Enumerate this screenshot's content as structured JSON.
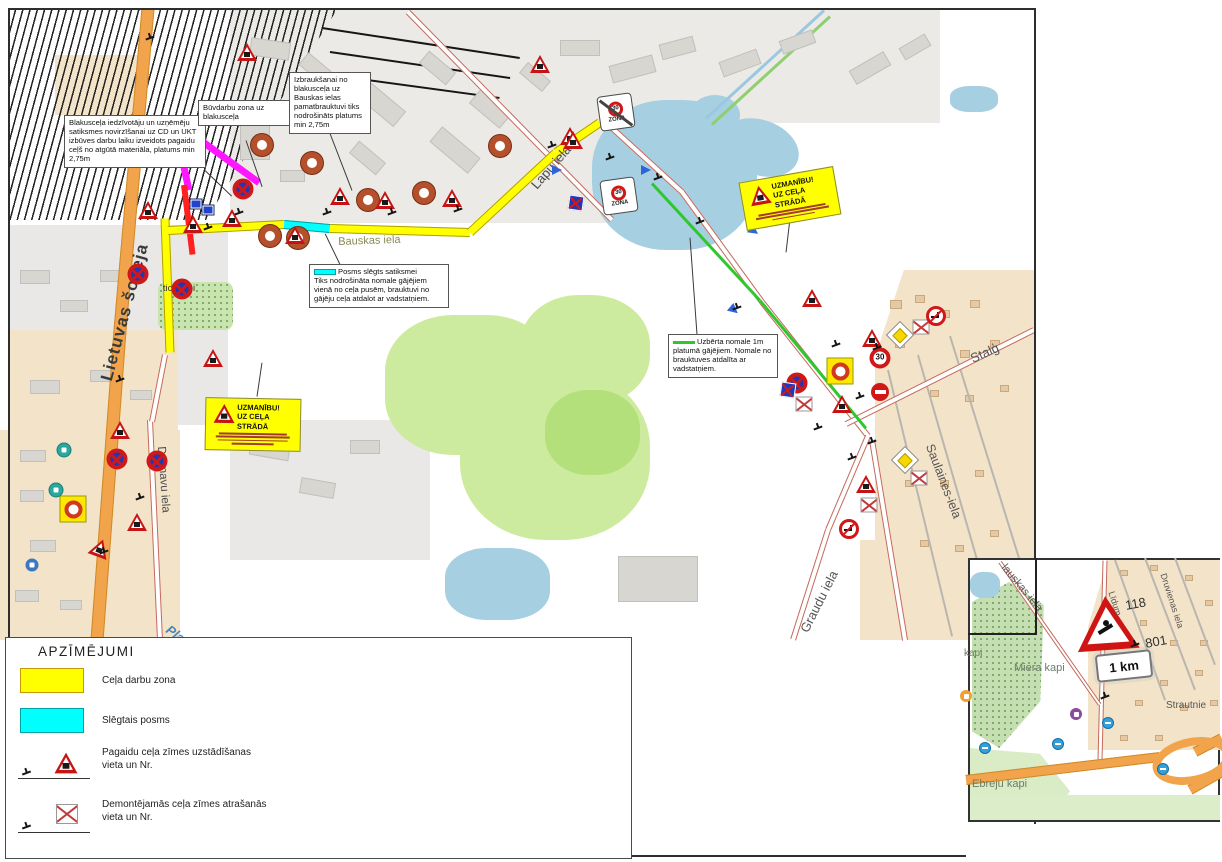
{
  "legend": {
    "title": "APZĪMĒJUMI",
    "items": [
      {
        "label": "Ceļa darbu zona",
        "swatch": "yellow"
      },
      {
        "label": "Slēgtais posms",
        "swatch": "cyan"
      },
      {
        "label": "Pagaidu ceļa zīmes uzstādīšanas vieta un Nr.",
        "swatch": "temporary-sign"
      },
      {
        "label": "Demontējamās ceļa zīmes atrašanās vieta un Nr.",
        "swatch": "removed-sign"
      }
    ]
  },
  "annotations": {
    "blakuscela": "Blakusceļa iedzīvotāju un uzņēmēju satiksmes novirzīšanai uz CD un UKT izbūves darbu laiku izveidots pagaidu ceļš no atgūtā materiāla, platums min 2,75m",
    "buvdarbu": "Būvdarbu zona uz blakusceļa",
    "izbrauksanai": "Izbraukšanai no blakusceļa uz Bauskas ielas pamatbrauktuvi tiks nodrošināts platums min 2,75m",
    "posms_title": "Posms slēgts  satiksmei",
    "posms_body": "Tiks nodrošināta nomale gājējiem vienā no ceļa pusēm, brauktuvi no gājēju ceļa atdalot ar vadstatņiem.",
    "uzberta": "Uzbērta nomale 1m platumā gājējiem. Nomale no brauktuves atdalīta ar vadstatņiem.",
    "warning_title": "UZMANĪBU!",
    "warning_subtitle": "UZ CEĻA STRĀDĀ"
  },
  "signs_text": {
    "thirty": "30",
    "zona": "ZONA"
  },
  "map_labels": [
    {
      "text": "Lietuvas šoseja",
      "x": 97,
      "y": 378,
      "rot": -75,
      "size": 17,
      "color": "#3a3a3a",
      "bold": true,
      "spacing": 1
    },
    {
      "text": "Bauskas iela",
      "x": 338,
      "y": 236,
      "rot": -2,
      "size": 11,
      "color": "#8a8a58",
      "bold": false
    },
    {
      "text": "Lapu iela",
      "x": 528,
      "y": 182,
      "rot": -49,
      "size": 13,
      "color": "#4a4a4a",
      "bold": false
    },
    {
      "text": "Dzirnavu iela",
      "x": 167,
      "y": 446,
      "rot": 86,
      "size": 11.5,
      "color": "#4a4a4a",
      "bold": false
    },
    {
      "text": "tic. kapi",
      "x": 160,
      "y": 283,
      "rot": 0,
      "size": 9.5,
      "color": "#333333",
      "bold": false,
      "w": 38
    },
    {
      "text": "Stalģ",
      "x": 968,
      "y": 352,
      "rot": -24,
      "size": 13,
      "color": "#555555",
      "bold": false
    },
    {
      "text": "Saulaines-iela",
      "x": 936,
      "y": 442,
      "rot": 69,
      "size": 12.5,
      "color": "#555555",
      "bold": false
    },
    {
      "text": "Graudu iela",
      "x": 797,
      "y": 628,
      "rot": -63,
      "size": 13,
      "color": "#555555",
      "bold": false
    },
    {
      "text": "Plat",
      "x": 172,
      "y": 622,
      "rot": 36,
      "size": 13,
      "color": "#4a86b8",
      "bold": true,
      "italic": true
    }
  ],
  "inset": {
    "km_plate": "1 km",
    "labels": [
      {
        "text": "Miera kapi",
        "x": 1014,
        "y": 662,
        "rot": 0,
        "size": 11,
        "color": "#6b7d66"
      },
      {
        "text": "Ebreju kapi",
        "x": 972,
        "y": 778,
        "rot": 0,
        "size": 11,
        "color": "#6b7d66"
      },
      {
        "text": "kapi",
        "x": 964,
        "y": 648,
        "rot": 0,
        "size": 10,
        "color": "#6b7d66"
      },
      {
        "text": "Strautnie",
        "x": 1166,
        "y": 700,
        "rot": 0,
        "size": 10,
        "color": "#555555"
      },
      {
        "text": "Druvienas iela",
        "x": 1168,
        "y": 572,
        "rot": 72,
        "size": 9,
        "color": "#555555"
      },
      {
        "text": "lauskas iela",
        "x": 1008,
        "y": 562,
        "rot": 50,
        "size": 11,
        "color": "#555555"
      },
      {
        "text": "Līdum",
        "x": 1116,
        "y": 590,
        "rot": 72,
        "size": 9,
        "color": "#555555"
      },
      {
        "text": "118",
        "x": 1124,
        "y": 598,
        "rot": -10,
        "size": 13,
        "color": "#333333"
      },
      {
        "text": "801",
        "x": 1144,
        "y": 636,
        "rot": -10,
        "size": 13,
        "color": "#333333"
      }
    ]
  },
  "signs": [
    [
      "donut",
      262,
      145
    ],
    [
      "donut",
      312,
      163
    ],
    [
      "donut",
      270,
      236
    ],
    [
      "donut",
      298,
      238
    ],
    [
      "donut",
      500,
      146
    ],
    [
      "donut",
      368,
      200
    ],
    [
      "donut",
      424,
      193
    ],
    [
      "tri",
      247,
      52
    ],
    [
      "tri",
      540,
      64
    ],
    [
      "tri",
      570,
      136
    ],
    [
      "tri",
      340,
      196
    ],
    [
      "tri",
      385,
      200
    ],
    [
      "tri",
      452,
      198
    ],
    [
      "tri",
      295,
      235
    ],
    [
      "tri",
      232,
      218
    ],
    [
      "tri",
      193,
      224
    ],
    [
      "tri",
      148,
      210
    ],
    [
      "tri",
      213,
      358
    ],
    [
      "tri",
      137,
      522
    ],
    [
      "tri",
      100,
      548,
      20
    ],
    [
      "tri",
      120,
      430
    ],
    [
      "tri",
      812,
      298
    ],
    [
      "tri",
      872,
      338
    ],
    [
      "tri",
      842,
      404
    ],
    [
      "tri",
      866,
      484
    ],
    [
      "tri",
      573,
      140
    ],
    [
      "nostop",
      138,
      274
    ],
    [
      "nostop",
      182,
      289
    ],
    [
      "nostop",
      243,
      189
    ],
    [
      "nostop",
      117,
      459
    ],
    [
      "nostop",
      157,
      461
    ],
    [
      "nostop",
      797,
      383
    ],
    [
      "bluecross",
      576,
      203
    ],
    [
      "bluecross",
      788,
      390
    ],
    [
      "noentry",
      880,
      392
    ],
    [
      "ydonut",
      73,
      509
    ],
    [
      "ydonut",
      840,
      371
    ],
    [
      "zonax",
      616,
      112
    ],
    [
      "zona",
      619,
      196
    ],
    [
      "s30",
      880,
      358
    ],
    [
      "ydiamond",
      900,
      335
    ],
    [
      "ydiamond",
      905,
      460
    ],
    [
      "crossed",
      921,
      327
    ],
    [
      "crossed",
      919,
      478
    ],
    [
      "crossed",
      869,
      505
    ],
    [
      "crossed",
      804,
      404
    ],
    [
      "noleft",
      936,
      316
    ],
    [
      "noleft",
      849,
      529
    ],
    [
      "bluerect",
      196,
      204
    ],
    [
      "bluerect",
      208,
      210
    ],
    [
      "bluearrow",
      557,
      170
    ],
    [
      "bluearrow",
      646,
      170
    ],
    [
      "bluearrow",
      754,
      231,
      35
    ],
    [
      "bluearrow",
      734,
      310,
      40
    ],
    [
      "teal",
      64,
      450
    ],
    [
      "teal",
      56,
      490
    ],
    [
      "bluepoi",
      32,
      565
    ],
    [
      "pole",
      150,
      38
    ],
    [
      "pole",
      239,
      213
    ],
    [
      "pole",
      208,
      228
    ],
    [
      "pole",
      327,
      213
    ],
    [
      "pole",
      392,
      213
    ],
    [
      "pole",
      458,
      210
    ],
    [
      "pole",
      552,
      146
    ],
    [
      "pole",
      610,
      158
    ],
    [
      "pole",
      658,
      178
    ],
    [
      "pole",
      700,
      222
    ],
    [
      "pole",
      737,
      308
    ],
    [
      "pole",
      818,
      428
    ],
    [
      "pole",
      852,
      458
    ],
    [
      "pole",
      877,
      348
    ],
    [
      "pole",
      140,
      498
    ],
    [
      "pole",
      104,
      552
    ],
    [
      "pole",
      872,
      442
    ],
    [
      "pole",
      860,
      397
    ],
    [
      "pole",
      836,
      345
    ],
    [
      "pole",
      120,
      380
    ]
  ],
  "inset_signs": [
    [
      "busdot",
      985,
      748
    ],
    [
      "busdot",
      1058,
      744
    ],
    [
      "busdot",
      1108,
      723
    ],
    [
      "busdot",
      1163,
      769
    ],
    [
      "purpoi",
      1076,
      714
    ],
    [
      "orgpoi",
      966,
      696
    ],
    [
      "pole",
      1105,
      697
    ],
    [
      "pole",
      1135,
      645
    ]
  ]
}
